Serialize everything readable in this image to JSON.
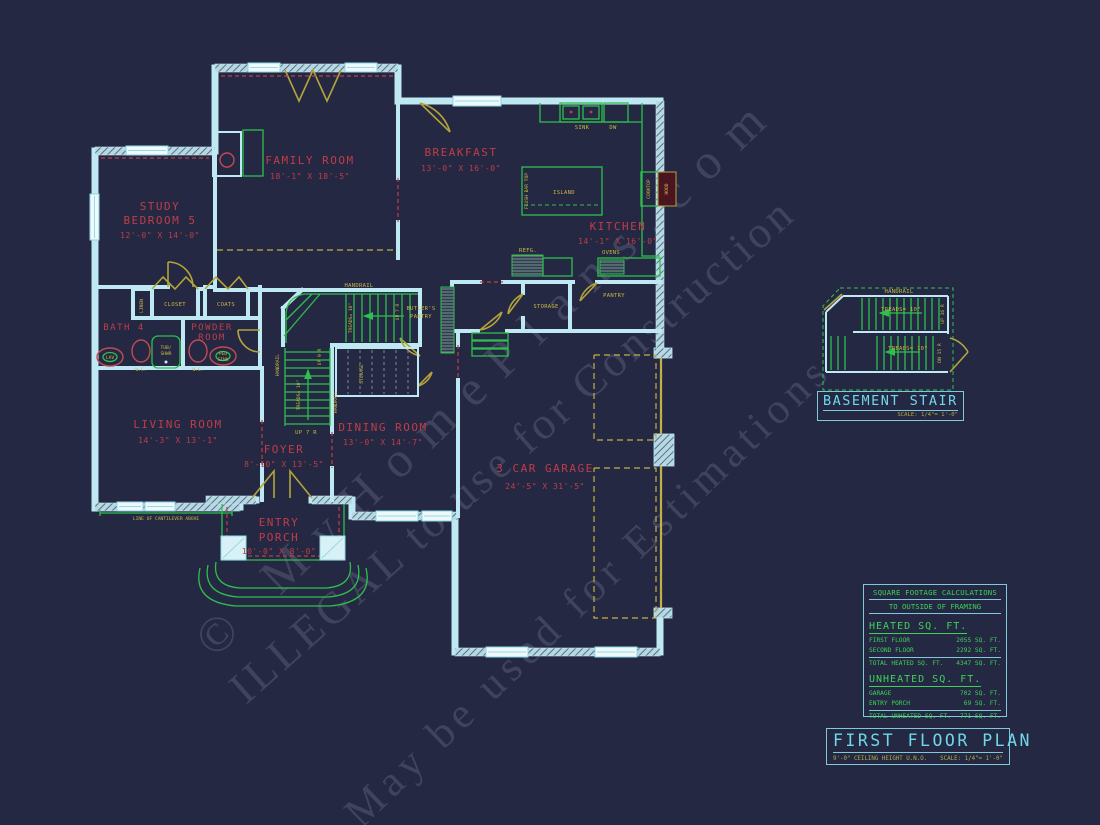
{
  "watermarks": {
    "line1": "© MyHomePlans.com",
    "line2": "ILLEGAL to use for Construction",
    "line3": "May be used for Estimations"
  },
  "rooms": {
    "study": {
      "name": "STUDY",
      "name2": "BEDROOM 5",
      "dims": "12'-0\" X 14'-0\""
    },
    "family": {
      "name": "FAMILY ROOM",
      "dims": "18'-1\" X 18'-5\""
    },
    "breakfast": {
      "name": "BREAKFAST",
      "dims": "13'-0\" X 16'-0\""
    },
    "kitchen": {
      "name": "KITCHEN",
      "dims": "14'-1\" X 16'-0\""
    },
    "bath4": {
      "name": "BATH 4"
    },
    "powder": {
      "name": "POWDER",
      "name2": "ROOM"
    },
    "living": {
      "name": "LIVING ROOM",
      "dims": "14'-3\" X 13'-1\""
    },
    "foyer": {
      "name": "FOYER",
      "dims": "8'-10\" X 13'-5\""
    },
    "dining": {
      "name": "DINING ROOM",
      "dims": "13'-0\" X 14'-7\""
    },
    "porch": {
      "name": "ENTRY",
      "name2": "PORCH",
      "dims": "10'-0\" X 8'-0\""
    },
    "garage": {
      "name": "3 CAR GARAGE",
      "dims": "24'-5\" X 31'-5\""
    }
  },
  "annotations": {
    "sink": "SINK",
    "dw": "DW",
    "island": "ISLAND",
    "flush_bar": "FLUSH BAR TOP",
    "cooktop": "COOKTOP",
    "hood": "HOOD",
    "refg": "REFG.",
    "ovens": "OVENS",
    "pantry": "PANTRY",
    "storage": "STORAGE",
    "storage_under": "STORAGE",
    "closet": "CLOSET",
    "coats": "COATS",
    "linen": "LINEN",
    "tub_line1": "TUB/",
    "tub_line2": "SHWR",
    "wc": "W.C.",
    "lav": "LAV",
    "ped_line1": "PED",
    "ped_line2": "SINK",
    "cantilever": "LINE OF CANTILEVER ABOVE",
    "handrail": "HANDRAIL",
    "treads": "TREADS= 10\"",
    "up7r": "UP 7 R",
    "up9r": "UP 9 R",
    "butlers_line1": "BUTLER'S",
    "butlers_line2": "PANTRY"
  },
  "basement_stair": {
    "title": "BASEMENT STAIR",
    "scale": "SCALE:  1/4\"= 1'-0\"",
    "handrail": "HANDRAIL",
    "treads": "TREADS= 10\"",
    "up": "UP 16 R",
    "dn": "DN 15 R"
  },
  "sqft_table": {
    "title1": "SQUARE FOOTAGE CALCULATIONS",
    "title2": "TO OUTSIDE OF FRAMING",
    "heated_header": "HEATED SQ. FT.",
    "rows_heated": [
      {
        "label": "FIRST FLOOR",
        "value": "2055  SQ. FT."
      },
      {
        "label": "SECOND FLOOR",
        "value": "2292 SQ. FT."
      }
    ],
    "total_heated": {
      "label": "TOTAL HEATED SQ. FT.",
      "value": "4347  SQ. FT."
    },
    "unheated_header": "UNHEATED SQ. FT.",
    "rows_unheated": [
      {
        "label": "GARAGE",
        "value": "702  SQ. FT."
      },
      {
        "label": "ENTRY PORCH",
        "value": "69  SQ. FT."
      }
    ],
    "total_unheated": {
      "label": "TOTAL UNHEATED SQ. FT.",
      "value": "771  SQ. FT."
    }
  },
  "title_block": {
    "title": "FIRST FLOOR PLAN",
    "note": "9'-0\" CEILING HEIGHT U.N.O.",
    "scale": "SCALE:  1/4\"= 1'-0\""
  },
  "colors": {
    "background": "#252843",
    "wall_cyan": "#bfe9f2",
    "label_red": "#bf3d47",
    "fixture_green": "#2ebf4d",
    "door_olive": "#b3a43b",
    "title_cyan": "#6fd8ea",
    "table_green": "#3fd157",
    "watermark_gray": "#ced3e6"
  }
}
